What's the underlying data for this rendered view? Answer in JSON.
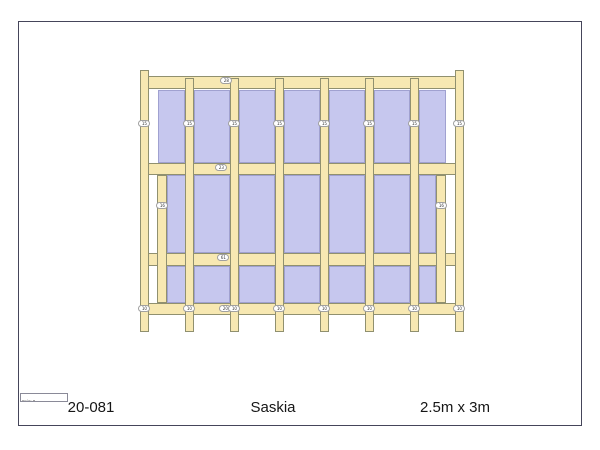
{
  "page": {
    "background": "#ffffff",
    "border_color": "#45455a"
  },
  "footer": {
    "order_number": "20-081",
    "model_name": "Saskia",
    "dimensions": "2.5m x 3m",
    "label_box_text": "Sein: 2"
  },
  "drawing": {
    "colors": {
      "wood": "#f7e8b2",
      "wood_outline": "#90906f",
      "panel": "#c6c7ee",
      "panel_outline": "#a0a1d0",
      "badge_bg": "#ffffff",
      "badge_border": "#a0a0a0",
      "badge_text": "#333333"
    },
    "rects": [
      {
        "type": "panel",
        "name": "wall-panel",
        "x": 158,
        "y": 90,
        "w": 27,
        "h": 73
      },
      {
        "type": "panel",
        "name": "wall-panel",
        "x": 194,
        "y": 90,
        "w": 36,
        "h": 73
      },
      {
        "type": "panel",
        "name": "wall-panel",
        "x": 239,
        "y": 90,
        "w": 36,
        "h": 73
      },
      {
        "type": "panel",
        "name": "wall-panel",
        "x": 284,
        "y": 90,
        "w": 36,
        "h": 73
      },
      {
        "type": "panel",
        "name": "wall-panel",
        "x": 329,
        "y": 90,
        "w": 36,
        "h": 73
      },
      {
        "type": "panel",
        "name": "wall-panel",
        "x": 374,
        "y": 90,
        "w": 36,
        "h": 73
      },
      {
        "type": "panel",
        "name": "wall-panel",
        "x": 419,
        "y": 90,
        "w": 27,
        "h": 73
      },
      {
        "type": "panel",
        "name": "wall-panel",
        "x": 167,
        "y": 175,
        "w": 27,
        "h": 78
      },
      {
        "type": "panel",
        "name": "wall-panel",
        "x": 194,
        "y": 175,
        "w": 36,
        "h": 78
      },
      {
        "type": "panel",
        "name": "wall-panel",
        "x": 239,
        "y": 175,
        "w": 36,
        "h": 78
      },
      {
        "type": "panel",
        "name": "wall-panel",
        "x": 284,
        "y": 175,
        "w": 36,
        "h": 78
      },
      {
        "type": "panel",
        "name": "wall-panel",
        "x": 329,
        "y": 175,
        "w": 36,
        "h": 78
      },
      {
        "type": "panel",
        "name": "wall-panel",
        "x": 374,
        "y": 175,
        "w": 36,
        "h": 78
      },
      {
        "type": "panel",
        "name": "wall-panel",
        "x": 419,
        "y": 175,
        "w": 17,
        "h": 78
      },
      {
        "type": "panel",
        "name": "wall-panel",
        "x": 167,
        "y": 266,
        "w": 27,
        "h": 37
      },
      {
        "type": "panel",
        "name": "wall-panel",
        "x": 194,
        "y": 266,
        "w": 36,
        "h": 37
      },
      {
        "type": "panel",
        "name": "wall-panel",
        "x": 239,
        "y": 266,
        "w": 36,
        "h": 37
      },
      {
        "type": "panel",
        "name": "wall-panel",
        "x": 284,
        "y": 266,
        "w": 36,
        "h": 37
      },
      {
        "type": "panel",
        "name": "wall-panel",
        "x": 329,
        "y": 266,
        "w": 36,
        "h": 37
      },
      {
        "type": "panel",
        "name": "wall-panel",
        "x": 374,
        "y": 266,
        "w": 36,
        "h": 37
      },
      {
        "type": "panel",
        "name": "wall-panel",
        "x": 419,
        "y": 266,
        "w": 17,
        "h": 37
      },
      {
        "type": "beam",
        "name": "top-beam",
        "x": 140,
        "y": 76,
        "w": 324,
        "h": 13
      },
      {
        "type": "beam",
        "name": "middle-rail-upper",
        "x": 140,
        "y": 163,
        "w": 324,
        "h": 12
      },
      {
        "type": "beam",
        "name": "middle-rail-lower",
        "x": 140,
        "y": 253,
        "w": 324,
        "h": 13
      },
      {
        "type": "beam",
        "name": "bottom-rail",
        "x": 140,
        "y": 303,
        "w": 324,
        "h": 12
      },
      {
        "type": "post",
        "name": "left-jamb-stud",
        "x": 157,
        "y": 175,
        "w": 10,
        "h": 128
      },
      {
        "type": "post",
        "name": "right-jamb-stud",
        "x": 436,
        "y": 175,
        "w": 10,
        "h": 128
      },
      {
        "type": "post",
        "name": "corner-post-left",
        "x": 140,
        "y": 70,
        "w": 9,
        "h": 262
      },
      {
        "type": "post",
        "name": "stud",
        "x": 185,
        "y": 78,
        "w": 9,
        "h": 254
      },
      {
        "type": "post",
        "name": "stud",
        "x": 230,
        "y": 78,
        "w": 9,
        "h": 254
      },
      {
        "type": "post",
        "name": "stud",
        "x": 275,
        "y": 78,
        "w": 9,
        "h": 254
      },
      {
        "type": "post",
        "name": "stud",
        "x": 320,
        "y": 78,
        "w": 9,
        "h": 254
      },
      {
        "type": "post",
        "name": "stud",
        "x": 365,
        "y": 78,
        "w": 9,
        "h": 254
      },
      {
        "type": "post",
        "name": "stud",
        "x": 410,
        "y": 78,
        "w": 9,
        "h": 254
      },
      {
        "type": "post",
        "name": "corner-post-right",
        "x": 455,
        "y": 70,
        "w": 9,
        "h": 262
      }
    ],
    "badges": [
      {
        "cx": 226,
        "cy": 81,
        "t": "28"
      },
      {
        "cx": 221,
        "cy": 168,
        "t": "23"
      },
      {
        "cx": 223,
        "cy": 258,
        "t": "61"
      },
      {
        "cx": 225,
        "cy": 309,
        "t": "20"
      },
      {
        "cx": 144,
        "cy": 124,
        "t": "15"
      },
      {
        "cx": 189,
        "cy": 124,
        "t": "15"
      },
      {
        "cx": 234,
        "cy": 124,
        "t": "15"
      },
      {
        "cx": 279,
        "cy": 124,
        "t": "15"
      },
      {
        "cx": 324,
        "cy": 124,
        "t": "15"
      },
      {
        "cx": 369,
        "cy": 124,
        "t": "15"
      },
      {
        "cx": 414,
        "cy": 124,
        "t": "15"
      },
      {
        "cx": 459,
        "cy": 124,
        "t": "15"
      },
      {
        "cx": 162,
        "cy": 206,
        "t": "16"
      },
      {
        "cx": 441,
        "cy": 206,
        "t": "16"
      },
      {
        "cx": 144,
        "cy": 309,
        "t": "10"
      },
      {
        "cx": 189,
        "cy": 309,
        "t": "10"
      },
      {
        "cx": 234,
        "cy": 309,
        "t": "10"
      },
      {
        "cx": 279,
        "cy": 309,
        "t": "10"
      },
      {
        "cx": 324,
        "cy": 309,
        "t": "10"
      },
      {
        "cx": 369,
        "cy": 309,
        "t": "10"
      },
      {
        "cx": 414,
        "cy": 309,
        "t": "10"
      },
      {
        "cx": 459,
        "cy": 309,
        "t": "10"
      }
    ]
  }
}
